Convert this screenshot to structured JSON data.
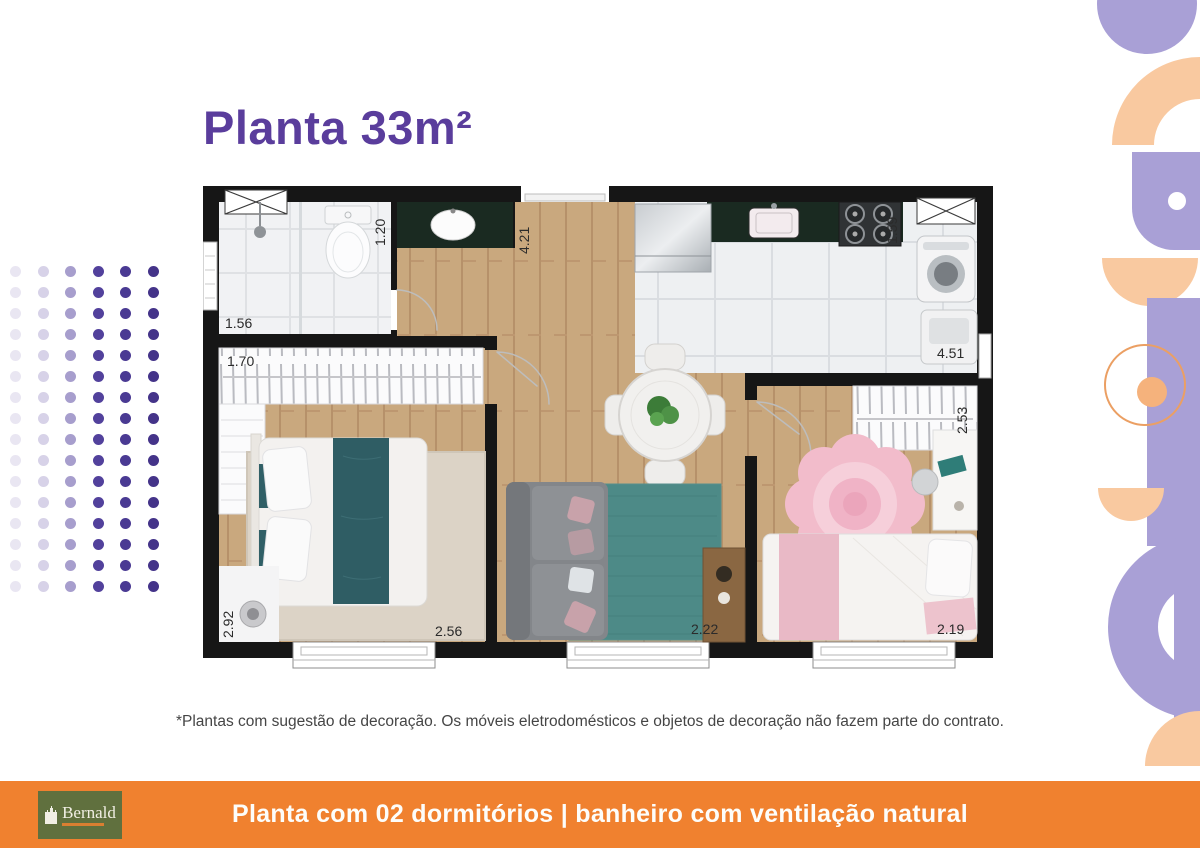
{
  "page": {
    "title_text": "Planta 33m²"
  },
  "disclaimer": "*Plantas com sugestão de decoração. Os móveis eletrodomésticos e objetos de decoração não fazem parte do contrato.",
  "footer": {
    "banner_text": "Planta com 02 dormitórios | banheiro com ventilação natural",
    "logo_text": "Bernald"
  },
  "floorplan": {
    "dims": {
      "shower_width": "1.56",
      "bathroom_width": "1.20",
      "hall_length": "4.21",
      "kitchen_width": "1.59",
      "kitchen_length": "4.51",
      "wardrobe_depth": "1.70",
      "bedroom1_length": "2.92",
      "bedroom1_width": "2.56",
      "living_width": "2.22",
      "bedroom2_width": "2.19",
      "bedroom2_length": "2.53"
    }
  },
  "theme": {
    "title_color": "#5a3d9c",
    "banner_color": "#f0812f",
    "logo_bg": "#60703e",
    "deco_purple": "#a9a0d6",
    "deco_orange": "#f9c9a0",
    "ring_stroke": "#eb9f63",
    "ring_dot": "#f5b27c",
    "wall_color": "#161616"
  },
  "deco": {
    "dots": {
      "rows": 16,
      "cols": 6,
      "col_gap": 27.5,
      "row_gap": 21,
      "colors": [
        "#e9e6f2",
        "#d7d2e8",
        "#a79ecd",
        "#52419c",
        "#4a3a93",
        "#443389"
      ]
    }
  }
}
